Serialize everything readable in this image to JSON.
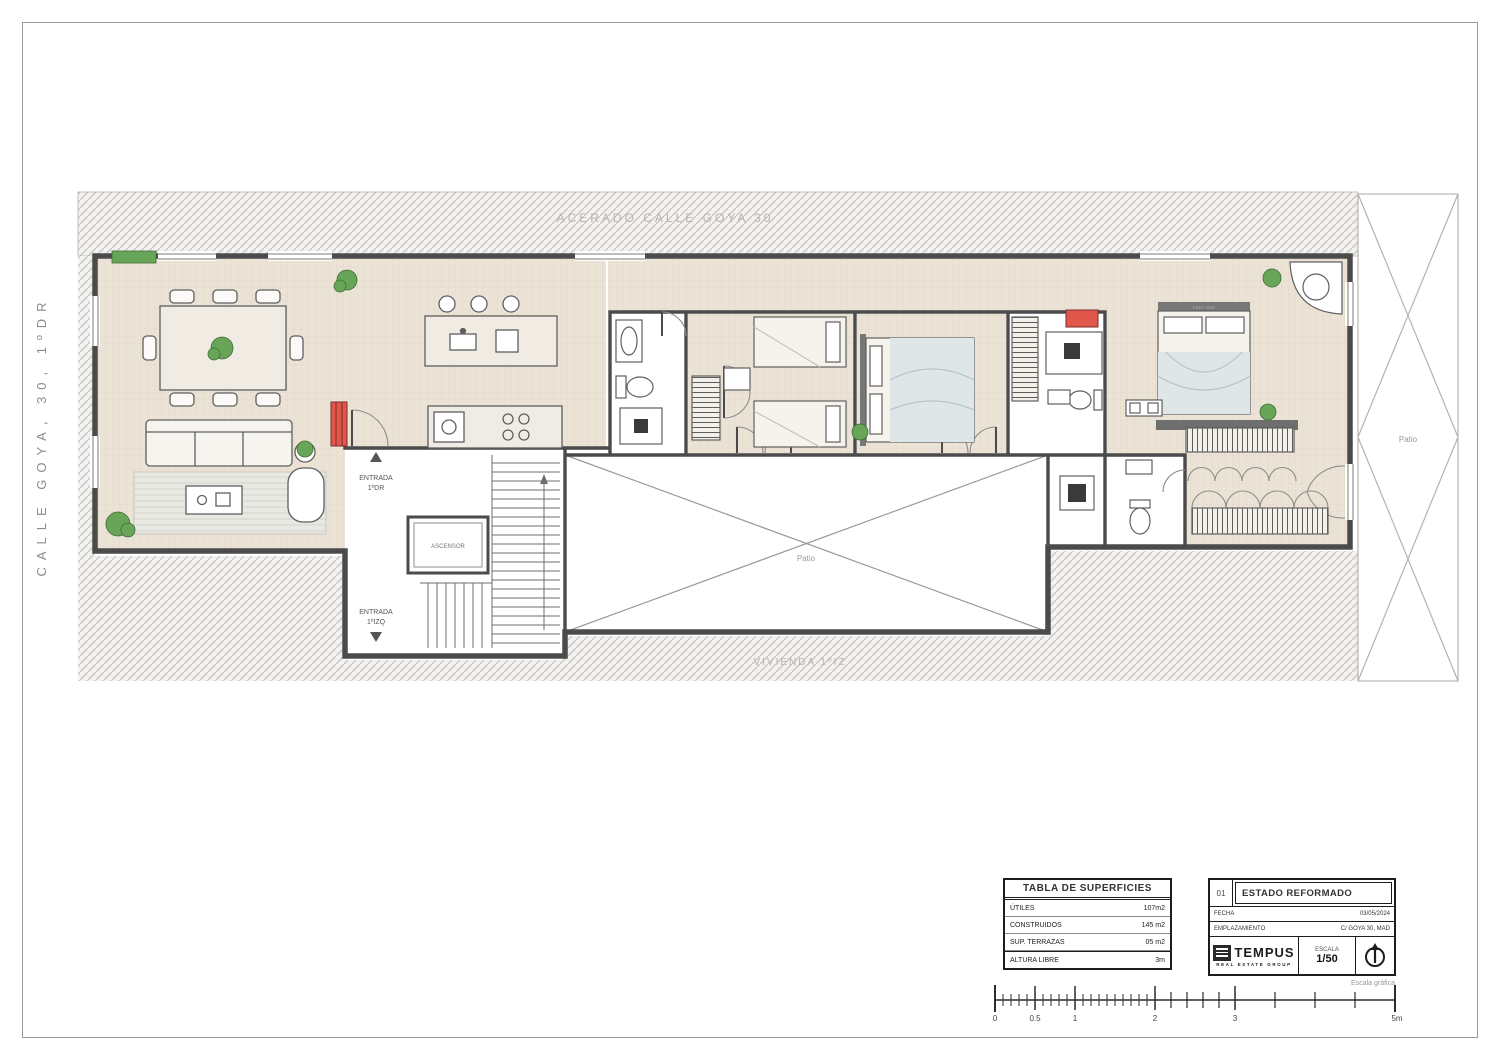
{
  "sheet": {
    "side_label": "CALLE GOYA, 30, 1ºDR"
  },
  "plan": {
    "street_label": "ACERADO CALLE GOYA 30",
    "dwelling_label": "VIVIENDA 1ºIZ",
    "patio_center_label": "Patio",
    "patio_right_label": "Patio",
    "entrance_top_line1": "ENTRADA",
    "entrance_top_line2": "1ºDR",
    "entrance_bottom_line1": "ENTRADA",
    "entrance_bottom_line2": "1ºIZQ",
    "elevator_label": "ASCENSOR",
    "master_bed_label": "KING SIZE"
  },
  "surface_table": {
    "title": "TABLA DE SUPERFICIES",
    "rows": [
      {
        "label": "ÚTILES",
        "value": "107m2"
      },
      {
        "label": "CONSTRUIDOS",
        "value": "145 m2"
      },
      {
        "label": "SUP. TERRAZAS",
        "value": "05 m2"
      },
      {
        "label": "ALTURA LIBRE",
        "value": "3m"
      }
    ]
  },
  "title_block": {
    "number": "01",
    "title": "ESTADO REFORMADO",
    "fecha_label": "FECHA",
    "fecha_value": "03/05/2024",
    "emplazamiento_label": "EMPLAZAMIENTO",
    "emplazamiento_value": "C/ GOYA 30, MAD",
    "logo_text": "TEMPUS",
    "logo_tagline": "REAL ESTATE GROUP",
    "escala_label": "ESCALA",
    "escala_value": "1/50"
  },
  "scale_bar": {
    "caption": "Escala gráfica",
    "labels": [
      "0",
      "0.5",
      "1",
      "2",
      "3",
      "5m"
    ]
  },
  "colors": {
    "accent_red": "#e2574c",
    "plant_green": "#69a558",
    "wall": "#4b4b4b",
    "floor_beige": "#ece3d7",
    "hatch_gray": "#c9c7c3"
  }
}
